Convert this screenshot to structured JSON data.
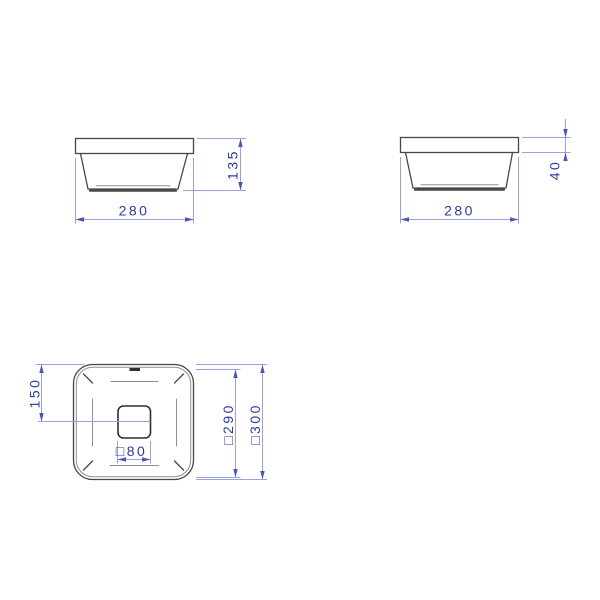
{
  "colors": {
    "background": "#ffffff",
    "object_line": "#474747",
    "object_dark": "#2e2e2e",
    "secondary_line": "#8f8f8f",
    "dimension_line": "#9aa2db",
    "dimension_text": "#2e3a9e",
    "dimension_arrow": "#4a55b5"
  },
  "views": {
    "front": {
      "width": "280",
      "height": "135"
    },
    "side": {
      "width": "280",
      "rim_height": "40"
    },
    "plan": {
      "center_distance": "150",
      "drain": "□80",
      "inner_square": "□290",
      "outer_square": "□300"
    }
  }
}
